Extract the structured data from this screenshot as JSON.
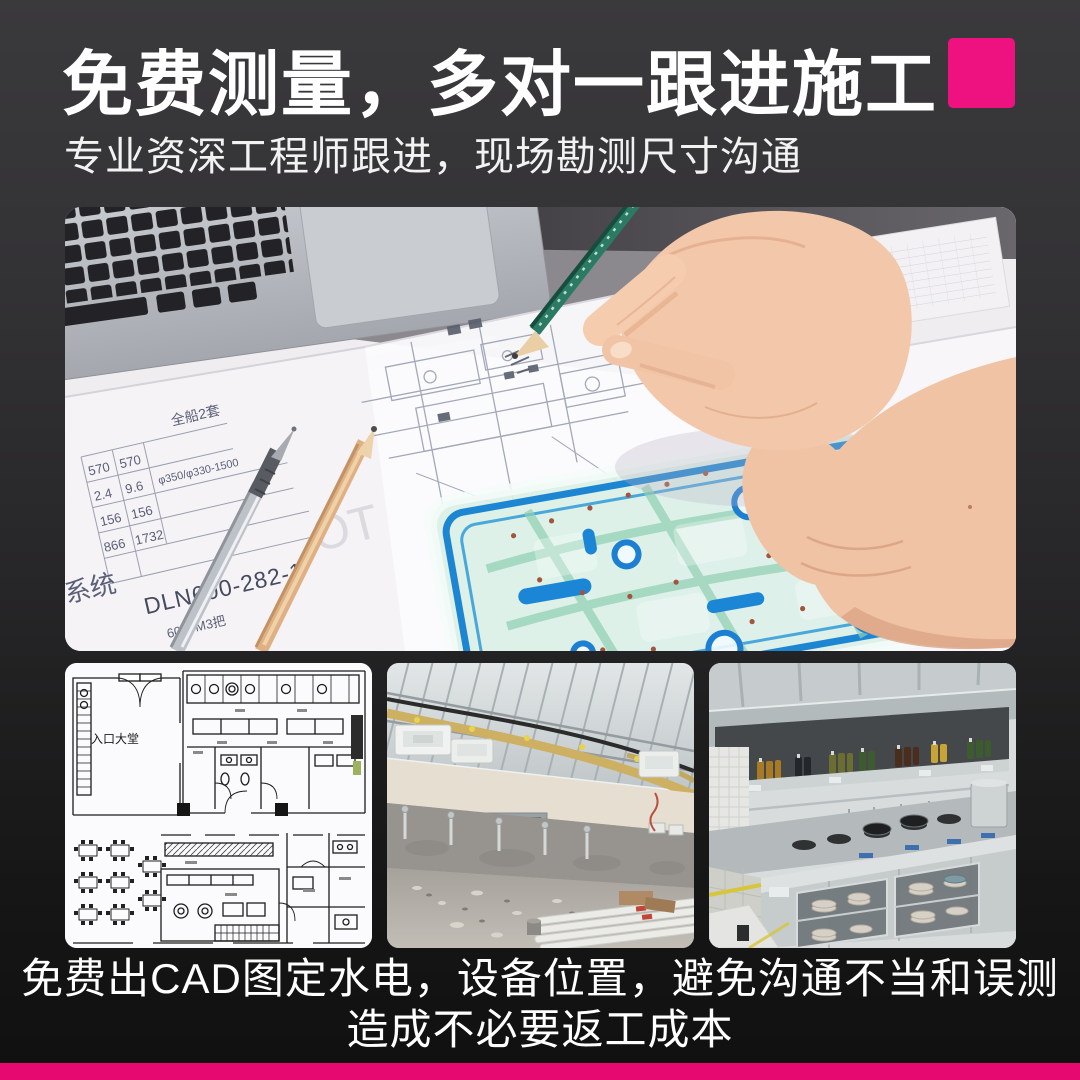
{
  "page": {
    "background_top": "#3a393c",
    "background_bottom": "#101010",
    "accent_color": "#ee1280",
    "bottom_bar_color": "#e60a70"
  },
  "header": {
    "title": "免费测量，多对一跟进施工",
    "subtitle": "专业资深工程师跟进，现场勘测尺寸沟通"
  },
  "hero": {
    "description": "photo: engineer hand with green pencil drawing on CAD blueprints beside a laptop, drafting stencil ruler on paper",
    "table": {
      "batch": "全船2套",
      "c1": [
        "570",
        "2.4",
        "156",
        "866"
      ],
      "c2": [
        "570",
        "9.6",
        "156",
        "1732"
      ],
      "spec": "φ350/φ330-1500",
      "model": "DLN600-282-1",
      "volume": "6000M3把",
      "system": "系统",
      "watermark": "OT"
    }
  },
  "gallery": {
    "floorplan_label": "入口大堂",
    "items": [
      {
        "name": "cad-floorplan"
      },
      {
        "name": "construction-site"
      },
      {
        "name": "commercial-kitchen"
      }
    ]
  },
  "footer": {
    "line1": "免费出CAD图定水电，设备位置，避免沟通不当和误测",
    "line2": "造成不必要返工成本"
  }
}
